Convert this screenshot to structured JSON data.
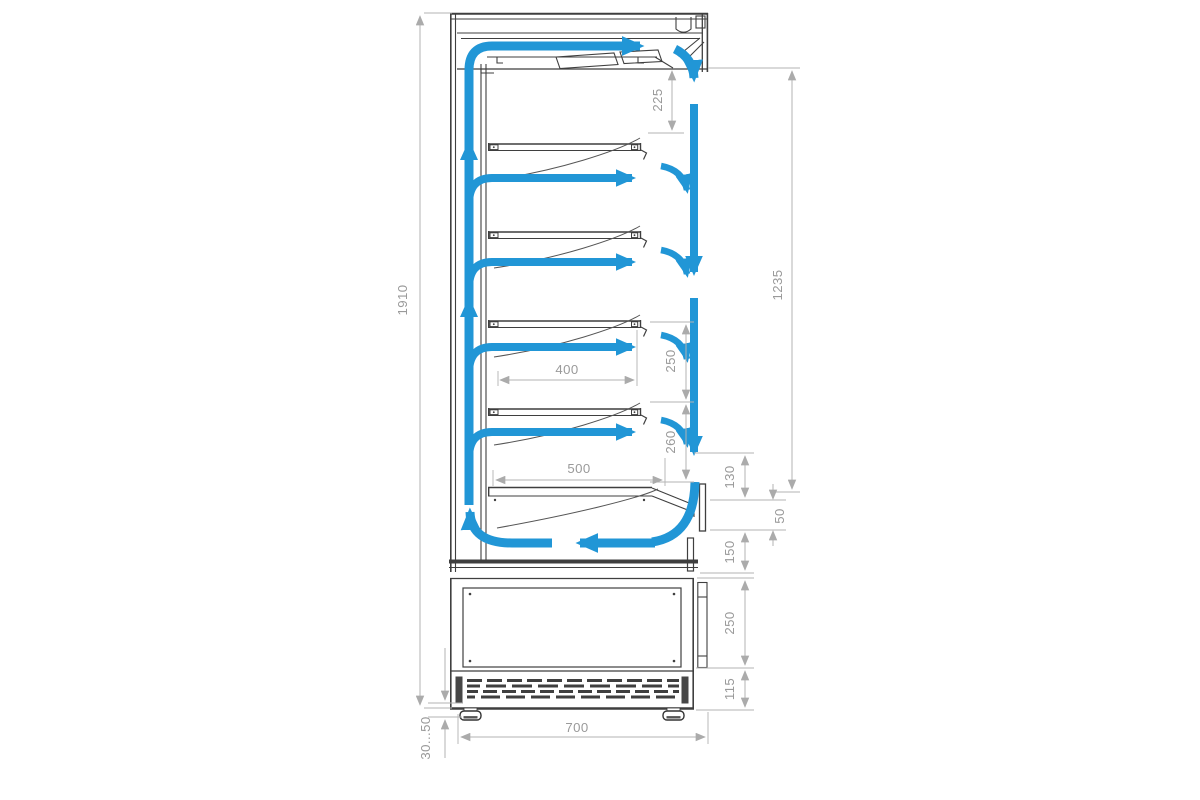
{
  "dims": {
    "overall_height": "1910",
    "top_section": "225",
    "air_curtain": "1235",
    "shelf_pitch": "250",
    "shelf_depth": "400",
    "bottom_pitch": "260",
    "bottom_shelf_depth": "500",
    "front_upper": "130",
    "intake_gap": "50",
    "front_lower": "150",
    "base_height": "250",
    "grille_height": "115",
    "depth": "700",
    "foot_height": "30...50"
  },
  "colors": {
    "airflow": "#2196d6",
    "line": "#3f3f3f",
    "dim-line": "#b3b3b3",
    "dim-text": "#9a9a9a"
  }
}
